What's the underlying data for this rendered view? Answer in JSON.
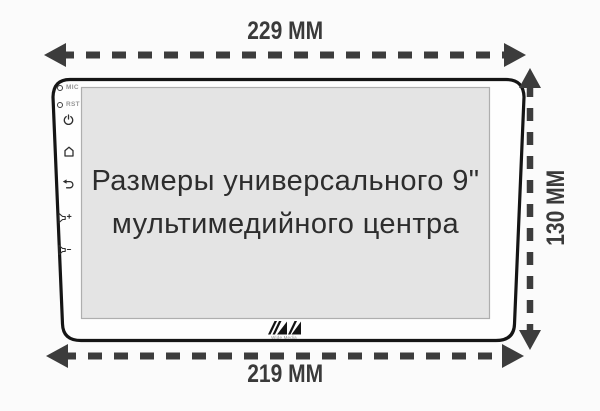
{
  "dimensions": {
    "top": "229 MM",
    "right": "130 MM",
    "bottom": "219 MM"
  },
  "screen": {
    "line1": "Размеры универсального 9\"",
    "line2": "мультимедийного центра"
  },
  "side_panel": {
    "mic_label": "MIC",
    "rst_label": "RST",
    "icons": [
      "power-icon",
      "home-icon",
      "back-icon",
      "volume-up-icon",
      "volume-down-icon"
    ]
  },
  "logo": {
    "brand": "Wide Media"
  },
  "colors": {
    "background": "#fbfbfb",
    "device_outline": "#151515",
    "screen_fill": "#e4e4e4",
    "screen_border": "#aeaeae",
    "arrow": "#3c3c3c",
    "dim_text": "#3a3a3a",
    "screen_text": "#2d2d2d",
    "led_label": "#969696"
  }
}
